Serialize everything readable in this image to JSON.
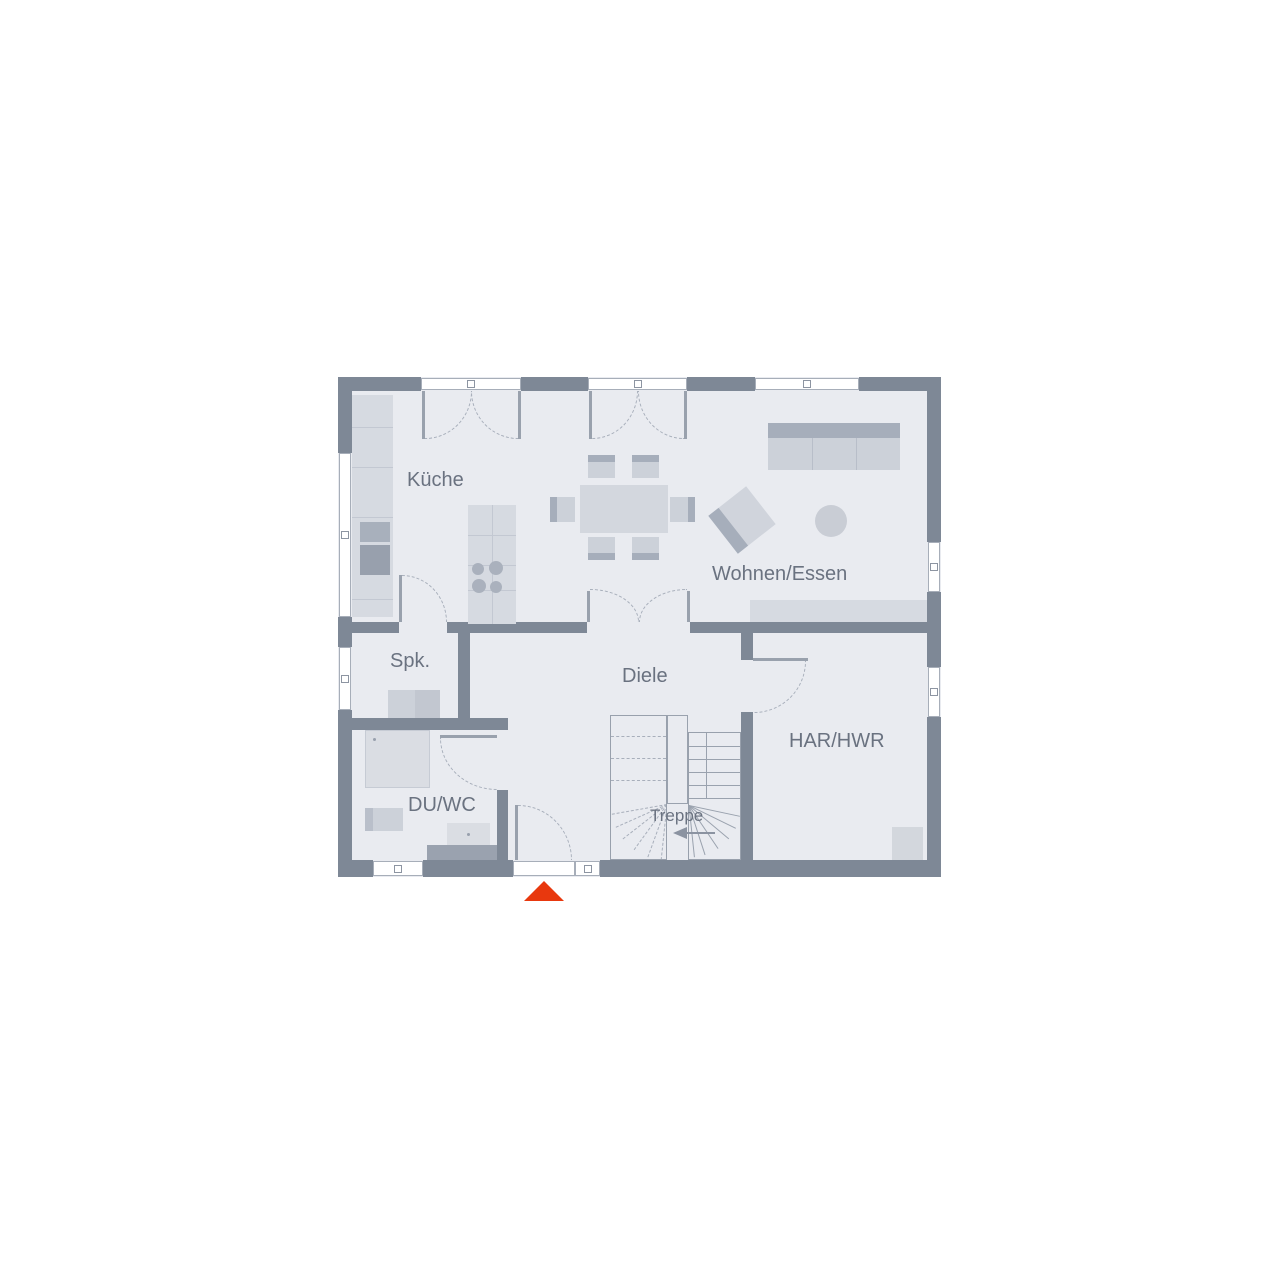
{
  "floor_plan": {
    "rooms": [
      {
        "id": "kueche",
        "label": "Küche"
      },
      {
        "id": "wohnen_essen",
        "label": "Wohnen/Essen"
      },
      {
        "id": "spk",
        "label": "Spk."
      },
      {
        "id": "diele",
        "label": "Diele"
      },
      {
        "id": "du_wc",
        "label": "DU/WC"
      },
      {
        "id": "treppe",
        "label": "Treppe"
      },
      {
        "id": "har_hwr",
        "label": "HAR/HWR"
      }
    ],
    "markers": {
      "entrance_icon": "entrance-arrow-triangle"
    },
    "colors": {
      "wall": "#7e8896",
      "floor": "#e9ebf0",
      "furniture_light": "#d6dae1",
      "furniture_mid": "#ccd1d9",
      "furniture_dark": "#a6aebb",
      "appliance": "#98a0ad",
      "outline": "#98a0ac",
      "label_text": "#6a7280",
      "entrance_accent": "#e8380e"
    }
  }
}
